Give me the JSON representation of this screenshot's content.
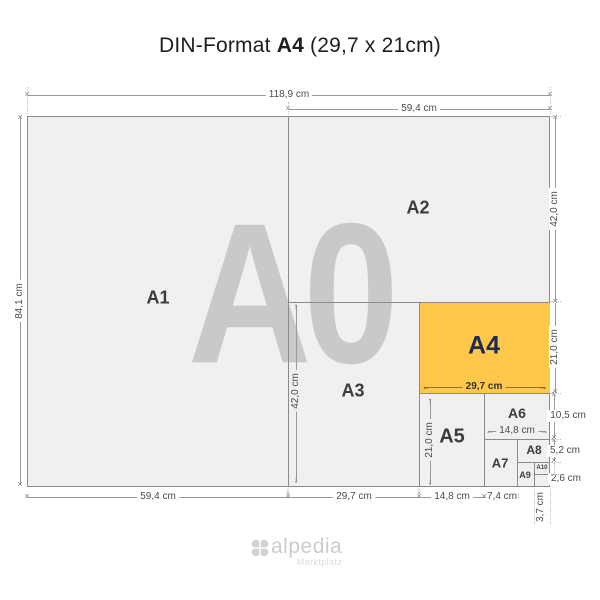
{
  "title": {
    "prefix": "DIN-Format",
    "format": "A4",
    "size": "(29,7 x 21cm)"
  },
  "watermark": "A0",
  "formats": {
    "a1": "A1",
    "a2": "A2",
    "a3": "A3",
    "a4": "A4",
    "a5": "A5",
    "a6": "A6",
    "a7": "A7",
    "a8": "A8",
    "a9": "A9",
    "a10": "A10"
  },
  "dims": {
    "total_width": "118,9 cm",
    "a2_width": "59,4 cm",
    "a0_height": "84,1 cm",
    "a2_height": "42,0 cm",
    "a4_height": "21,0 cm",
    "a6_height": "10,5 cm",
    "a8_height": "5,2 cm",
    "a10_height": "2,6 cm",
    "a1_width": "59,4 cm",
    "a3_width": "29,7 cm",
    "a5_width": "14,8 cm",
    "a7_width": "7,4 cm",
    "a9_width": "3,7 cm",
    "a3_height": "42,0 cm",
    "a4_width": "29,7 cm",
    "a5_height": "21,0 cm",
    "a6_width": "14,8 cm"
  },
  "icons": {
    "dim_end": "✕",
    "arrow_up": "↑",
    "arrow_down": "↓",
    "arrow_left": "←",
    "arrow_right": "→",
    "logo_flower": "four-petal-clover"
  },
  "colors": {
    "highlight": "#FFC84D",
    "paper": "#F0F0F0",
    "line": "#8A8A8A",
    "watermark": "#C9C9C9",
    "a4_label": "#1D2B50"
  },
  "logo": {
    "name": "alpedia",
    "tagline": "Marktplatz"
  }
}
